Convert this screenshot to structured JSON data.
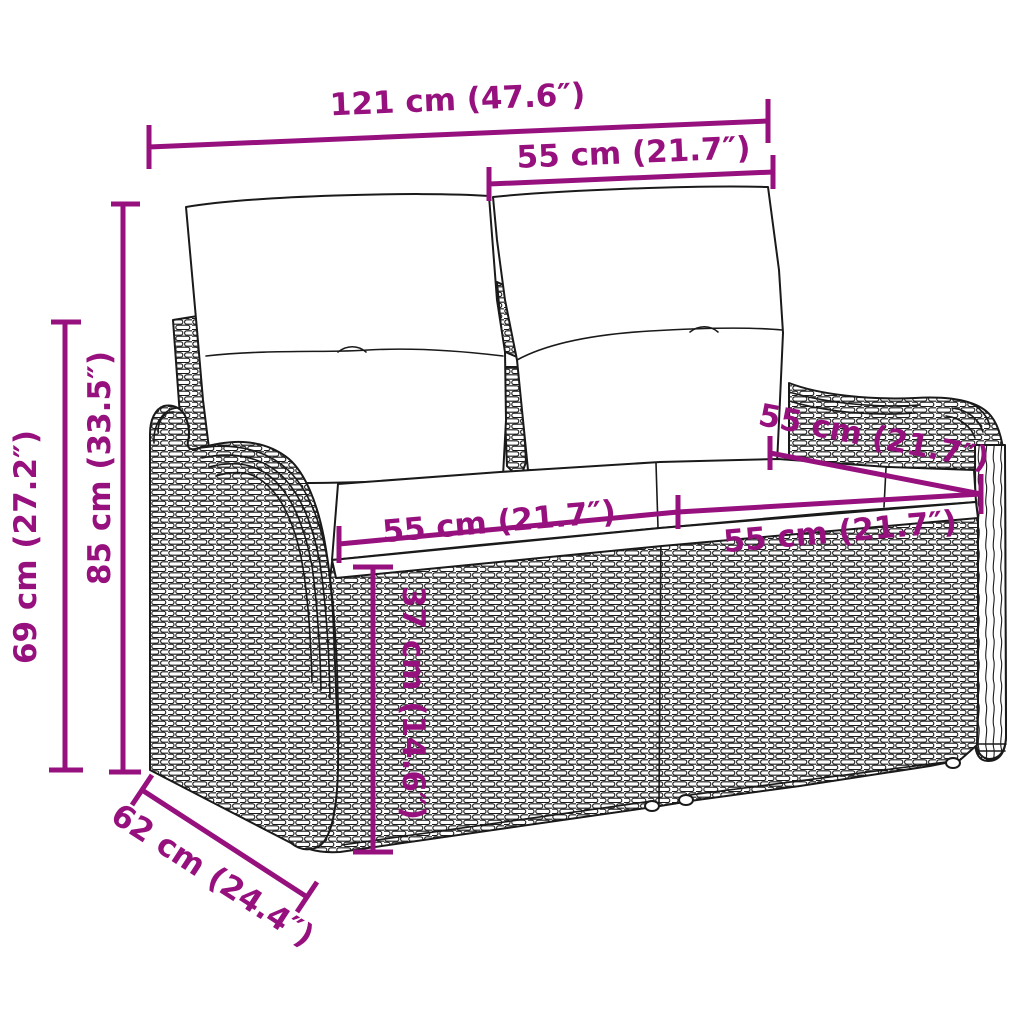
{
  "diagram": {
    "type": "product-dimension-diagram",
    "subject": "2-seater poly rattan garden bench with back and seat cushions",
    "unit_primary": "cm",
    "unit_secondary": "inch",
    "dimensions": {
      "overall_width": {
        "label": "121 cm (47.6″)",
        "cm": 121,
        "inch": 47.6
      },
      "backrest_width": {
        "label": "55 cm (21.7″)",
        "cm": 55,
        "inch": 21.7
      },
      "overall_height": {
        "label": "85 cm (33.5″)",
        "cm": 85,
        "inch": 33.5
      },
      "armrest_height": {
        "label": "69 cm (27.2″)",
        "cm": 69,
        "inch": 27.2
      },
      "seat_width_left": {
        "label": "55 cm (21.7″)",
        "cm": 55,
        "inch": 21.7
      },
      "seat_width_right": {
        "label": "55 cm (21.7″)",
        "cm": 55,
        "inch": 21.7
      },
      "seat_depth": {
        "label": "55 cm (21.7″)",
        "cm": 55,
        "inch": 21.7
      },
      "seat_height": {
        "label": "37 cm (14.6″)",
        "cm": 37,
        "inch": 14.6
      },
      "overall_depth": {
        "label": "62 cm (24.4″)",
        "cm": 62,
        "inch": 24.4
      }
    },
    "colors": {
      "accent": "#96107E",
      "line_art": "#1a1a1a",
      "background": "#ffffff"
    }
  }
}
